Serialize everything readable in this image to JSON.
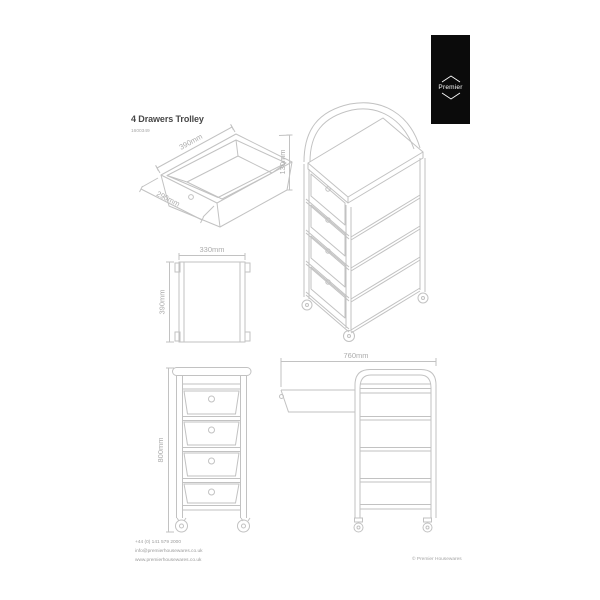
{
  "sheet": {
    "title": "4 Drawers Trolley",
    "product_code": "1600349",
    "copyright": "© Premier Housewares"
  },
  "brand": {
    "name": "Premier"
  },
  "contact": {
    "phone": "+44 (0) 141 579 2000",
    "email": "info@premierhousewares.co.uk",
    "website": "www.premierhousewares.co.uk"
  },
  "dimensions": {
    "drawer": {
      "width": "390mm",
      "depth": "290mm",
      "height": "130mm"
    },
    "top_view": {
      "width": "330mm",
      "depth": "390mm"
    },
    "front_view": {
      "height": "800mm"
    },
    "side_view": {
      "overall_width": "760mm"
    }
  },
  "colors": {
    "line": "#c2c2c2",
    "dim_text": "#acacac",
    "logo_bg": "#0b0b0b",
    "logo_fg": "#ffffff"
  }
}
